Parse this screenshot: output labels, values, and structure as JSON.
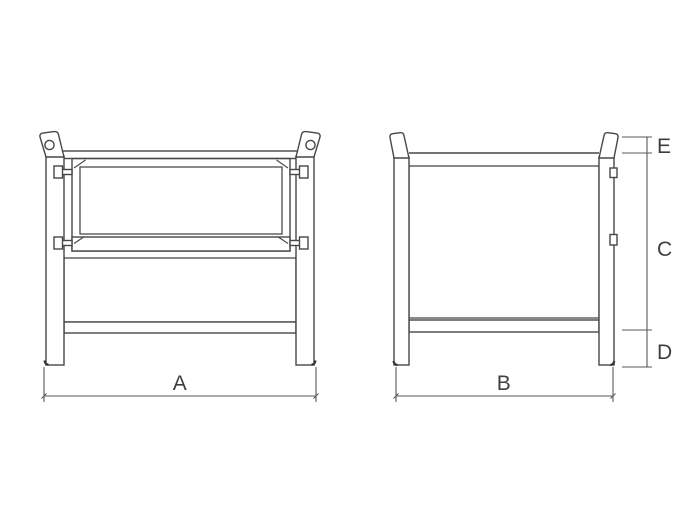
{
  "diagram": {
    "type": "technical-drawing",
    "subject": "steel wire mesh pallet container with half-drop gate, two orthographic views",
    "views": [
      {
        "name": "front-elevation",
        "width_dimension_label": "A"
      },
      {
        "name": "side-elevation",
        "width_dimension_label": "B",
        "height_dimension_labels": [
          "E",
          "C",
          "D"
        ]
      }
    ],
    "labels": {
      "A": "A",
      "B": "B",
      "C": "C",
      "D": "D",
      "E": "E"
    },
    "colors": {
      "background": "#ffffff",
      "line": "#474747",
      "dimension_line": "#5a5a5a",
      "label_text": "#3f3f3f"
    }
  }
}
